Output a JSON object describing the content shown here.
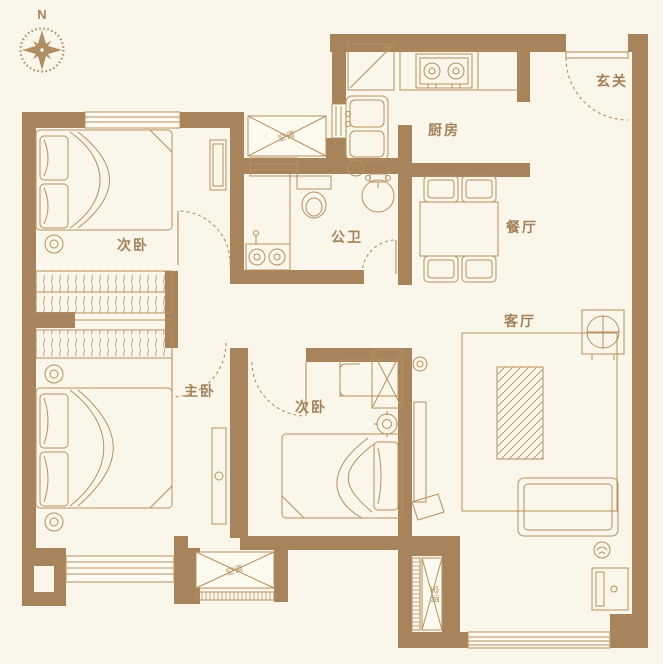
{
  "compass": {
    "north_label": "N"
  },
  "rooms": {
    "entry": {
      "label": "玄关"
    },
    "kitchen": {
      "label": "厨房"
    },
    "dining": {
      "label": "餐厅"
    },
    "living": {
      "label": "客厅"
    },
    "bathroom": {
      "label": "公卫"
    },
    "bedroom_top": {
      "label": "次卧"
    },
    "bedroom_middle": {
      "label": "次卧"
    },
    "bedroom_master": {
      "label": "主卧"
    }
  },
  "annotations": {
    "ac_top": {
      "label": "空调"
    },
    "ac_bottom": {
      "label": "空调"
    },
    "ac_duct": {
      "label": "空调"
    }
  },
  "colors": {
    "background": "#faf6ea",
    "wall": "#a8845c",
    "furniture_line": "#b7905f",
    "label_text": "#a2825a"
  }
}
